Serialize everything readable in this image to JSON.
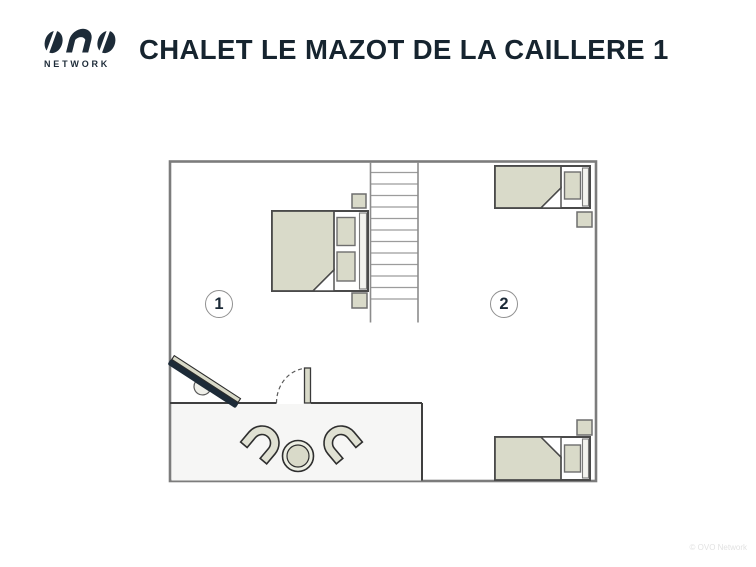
{
  "header": {
    "logo": {
      "brand": "OVO",
      "subtext": "NETWORK"
    },
    "title": "CHALET LE MAZOT DE LA CAILLERE 1"
  },
  "floorplan": {
    "rooms": [
      {
        "number": "1"
      },
      {
        "number": "2"
      }
    ],
    "icons": [
      "stairs-icon",
      "double-bed-icon",
      "single-bed-icon",
      "single-bed-icon",
      "nightstand-icon",
      "nightstand-icon",
      "nightstand-icon",
      "nightstand-icon",
      "tv-icon",
      "door-icon",
      "round-table-icon",
      "armchair-icon",
      "armchair-icon"
    ]
  },
  "footer": {
    "copyright": "© OVO Network"
  },
  "colors": {
    "brand_navy": "#1d2b38",
    "title_navy": "#16242f",
    "furniture_beige": "#d9dac9",
    "outer_wall_grey": "#7c7c7c",
    "partition_dark": "#3f3f3f",
    "landing_fill": "#f6f6f5",
    "background": "#ffffff"
  }
}
